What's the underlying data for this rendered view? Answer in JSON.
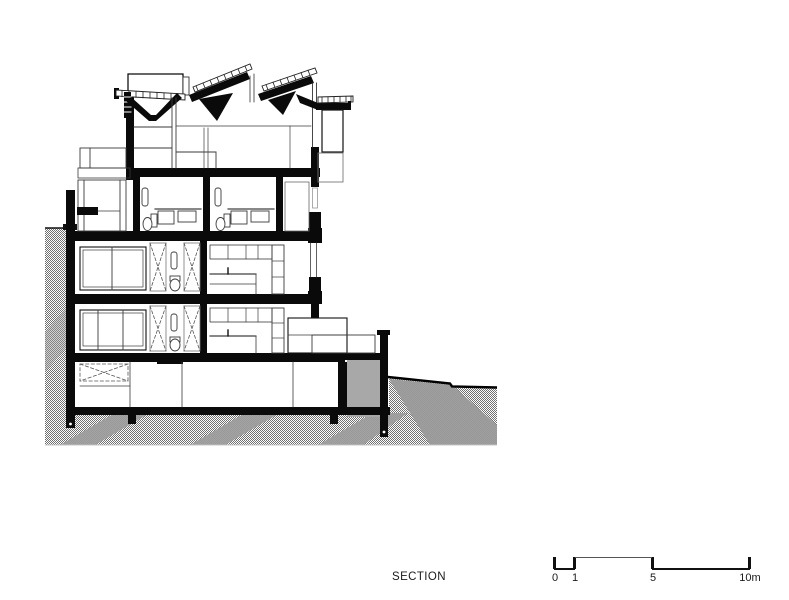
{
  "labels": {
    "title": "SECTION"
  },
  "scale_bar": {
    "tick_labels": [
      "0",
      "1",
      "5",
      "10m"
    ],
    "unit": "m",
    "max_value": 10
  },
  "colors": {
    "ink": "#000000",
    "paper": "#ffffff",
    "ground_hatch": "#707070",
    "ground_band": "#9c9c9c",
    "ground_solid": "#a8a8a8",
    "thin_line": "#3a3a3a"
  },
  "drawing_parts": [
    "sawtooth-roof-skylights",
    "upper-floor",
    "bathroom-floor",
    "living-floor-upper",
    "living-floor-lower",
    "basement",
    "retaining-wall",
    "ground-hatch",
    "terrain-slope"
  ]
}
